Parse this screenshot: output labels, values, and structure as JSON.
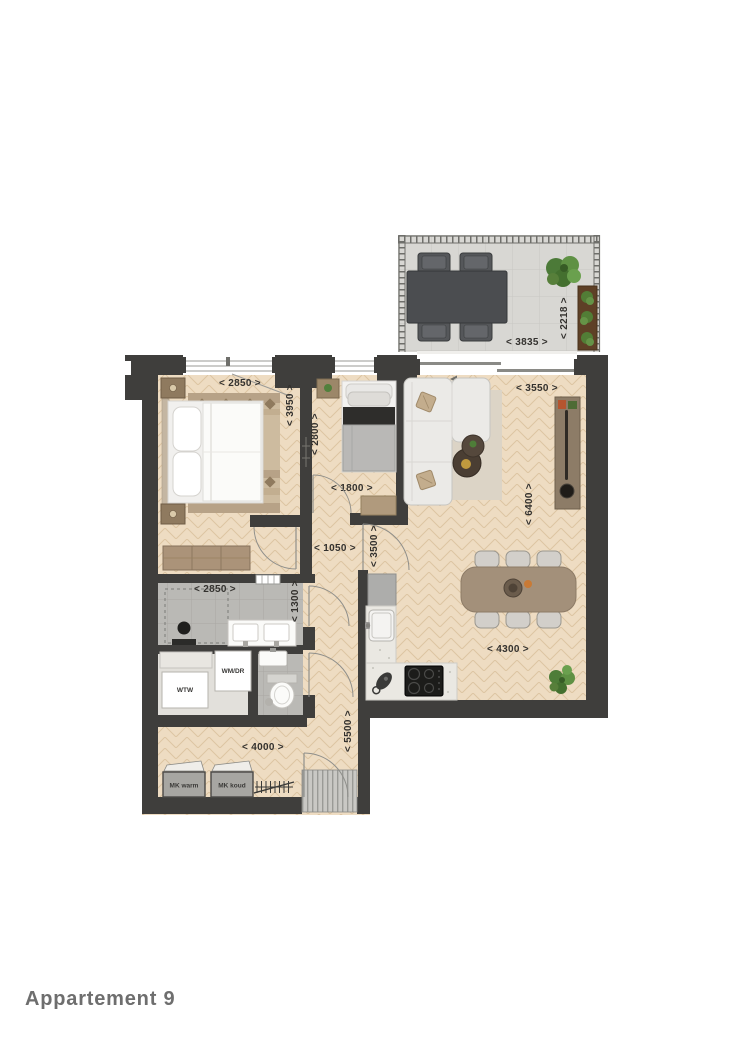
{
  "title": "Appartement 9",
  "dimensions": {
    "balcony_width": "< 3835 >",
    "balcony_depth": "< 2218 >",
    "bedroom_width": "< 2850 >",
    "bedroom_depth": "< 3950 >",
    "study_depth": "< 2800 >",
    "study_width": "< 1800 >",
    "living_width": "< 3550 >",
    "living_depth": "< 6400 >",
    "hall_width": "< 1050 >",
    "hall_depth": "< 3500 >",
    "bathroom_width": "< 2850 >",
    "bathroom_depth": "< 1300 >",
    "dining_width": "< 4300 >",
    "entry_hall_width": "< 4000 >",
    "entry_hall_depth": "< 5500 >"
  },
  "labels": {
    "washer_dryer": "WM/DR",
    "heat_recovery": "WTW",
    "meter_warm": "MK warm",
    "meter_cold": "MK koud"
  },
  "colors": {
    "wall": "#3f3e3c",
    "wood_floor": "#eedcc2",
    "tile_floor": "#bab9b5",
    "balcony_floor": "#d8d7d3",
    "plant_green": "#55823d",
    "dimension_text": "#33312e",
    "title_text": "#6e6e6e"
  }
}
